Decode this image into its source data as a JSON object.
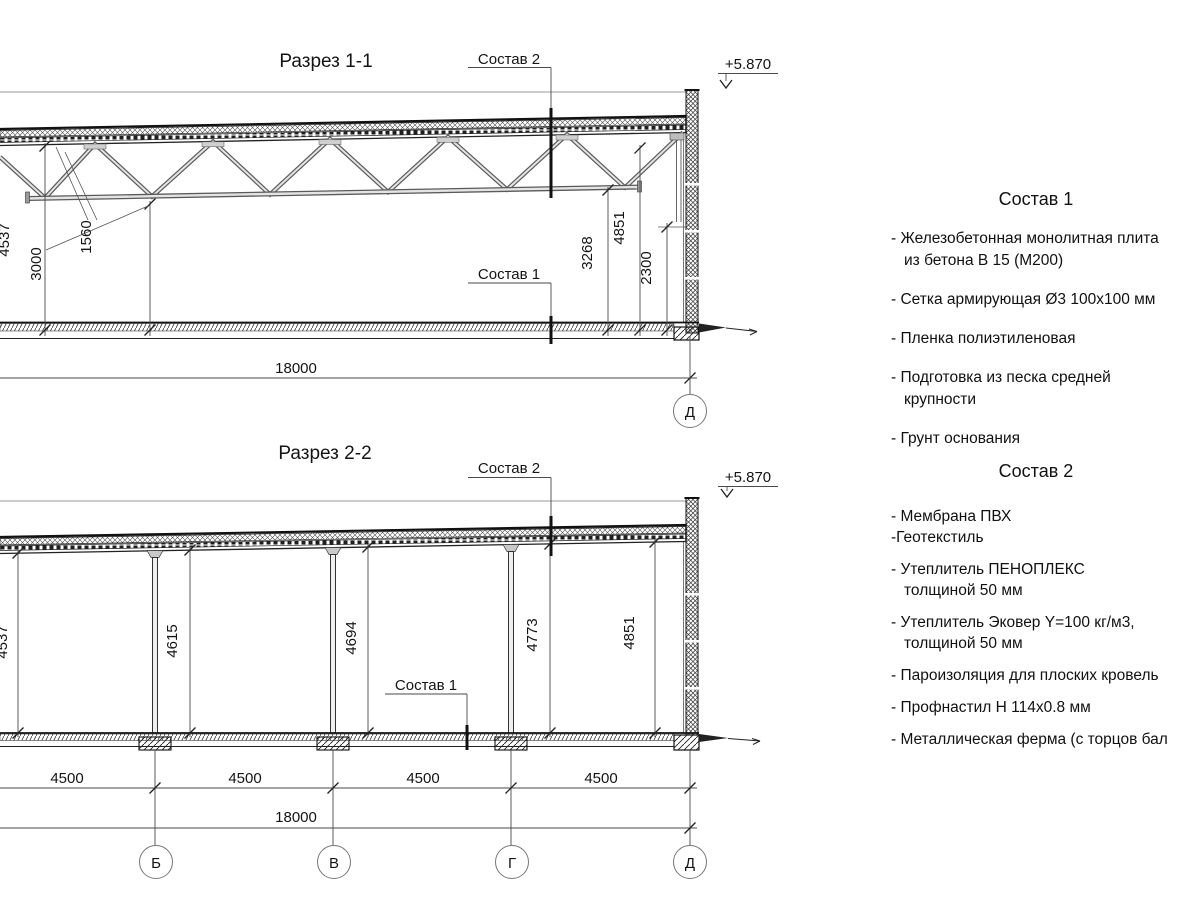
{
  "sections": {
    "s1": {
      "title": "Разрез 1-1",
      "composition2_label": "Состав 2",
      "composition1_label": "Состав 1",
      "elevation": "+5.870",
      "dims": {
        "left_height": "4537",
        "truss_depth": "1560",
        "clear_height": "3000",
        "truss_bottom": "3268",
        "right_height": "4851",
        "wall_panel": "2300",
        "total_span": "18000"
      },
      "grid_axes": {
        "d": "Д"
      }
    },
    "s2": {
      "title": "Разрез 2-2",
      "composition2_label": "Состав 2",
      "composition1_label": "Состав 1",
      "elevation": "+5.870",
      "dims": {
        "h_a": "4537",
        "h_b": "4615",
        "h_v": "4694",
        "h_g": "4773",
        "h_d": "4851",
        "bay": "4500",
        "total_span": "18000"
      },
      "grid_axes": {
        "b": "Б",
        "v": "В",
        "g": "Г",
        "d": "Д"
      }
    }
  },
  "legend1": {
    "title": "Состав 1",
    "items": [
      "- Железобетонная  монолитная плита\nиз бетона В 15 (М200)",
      "- Сетка армирующая Ø3 100х100 мм",
      "- Пленка полиэтиленовая",
      "- Подготовка из песка средней\nкрупности",
      "- Грунт основания"
    ]
  },
  "legend2": {
    "title": "Состав 2",
    "items": [
      "- Мембрана ПВХ",
      "-Геотекстиль",
      "- Утеплитель ПЕНОПЛЕКС\nтолщиной 50 мм",
      "- Утеплитель Эковер Y=100 кг/м3,\nтолщиной 50 мм",
      "- Пароизоляция для плоских кровель",
      "- Профнастил Н 114х0.8 мм",
      "- Металлическая ферма (с торцов бал"
    ]
  }
}
